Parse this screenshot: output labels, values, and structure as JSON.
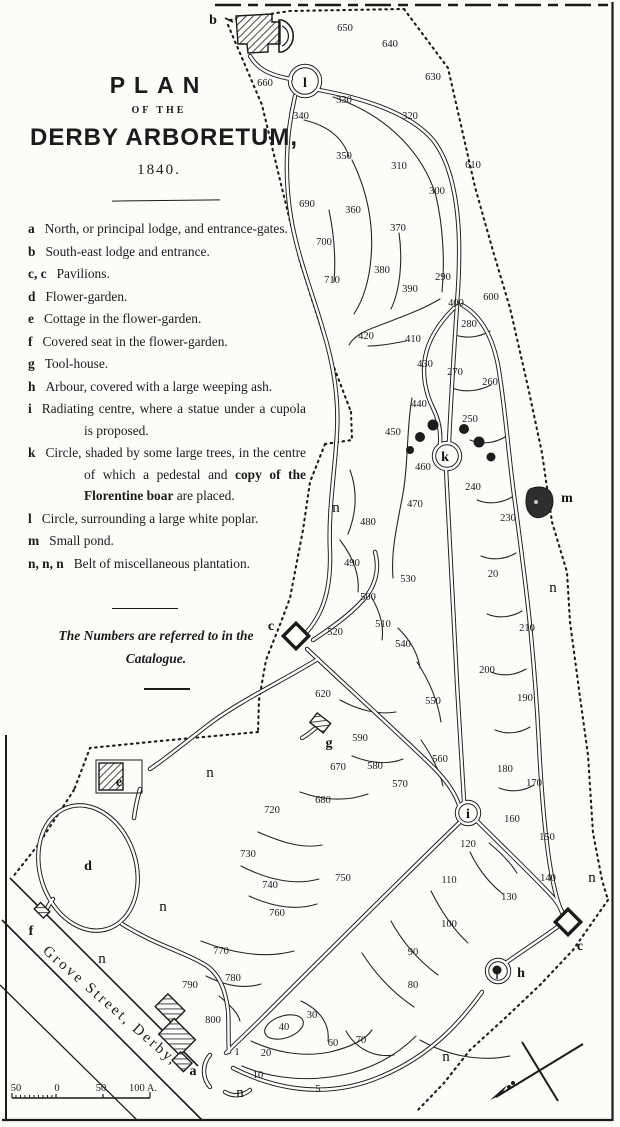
{
  "title": {
    "plan": "PLAN",
    "of_the": "OF THE",
    "name": "DERBY ARBORETUM,",
    "year": "1840."
  },
  "legend": {
    "items": [
      {
        "key": "a",
        "text": "North, or principal lodge, and entrance-gates."
      },
      {
        "key": "b",
        "text": "South-east lodge and entrance."
      },
      {
        "key": "c, c",
        "text": "Pavilions."
      },
      {
        "key": "d",
        "text": "Flower-garden."
      },
      {
        "key": "e",
        "text": "Cottage in the flower-garden."
      },
      {
        "key": "f",
        "text": "Covered seat in the flower-garden."
      },
      {
        "key": "g",
        "text": "Tool-house."
      },
      {
        "key": "h",
        "text": "Arbour, covered with a large weeping ash."
      },
      {
        "key": "i",
        "text": "Radiating centre, where a statue under a cupola is proposed."
      },
      {
        "key": "k",
        "text_before": "Circle, shaded by some large trees, in the centre of which a pedestal and ",
        "bold": "copy of the Florentine boar",
        "text_after": " are placed."
      },
      {
        "key": "l",
        "text": "Circle, surrounding a large white poplar."
      },
      {
        "key": "m",
        "text": "Small pond."
      },
      {
        "key": "n, n, n",
        "text": "Belt of miscellaneous plantation."
      }
    ]
  },
  "note": "The Numbers are referred to in the Catalogue.",
  "map": {
    "street": "Grove Street, Derby,",
    "scale_labels": [
      "50",
      "0",
      "50",
      "100 A."
    ],
    "letters": [
      {
        "t": "b",
        "x": 213,
        "y": 24
      },
      {
        "t": "l",
        "x": 305,
        "y": 87
      },
      {
        "t": "a",
        "x": 193,
        "y": 1075
      },
      {
        "t": "c",
        "x": 271,
        "y": 630
      },
      {
        "t": "c",
        "x": 580,
        "y": 950
      },
      {
        "t": "d",
        "x": 88,
        "y": 870
      },
      {
        "t": "e",
        "x": 119,
        "y": 786
      },
      {
        "t": "f",
        "x": 31,
        "y": 935
      },
      {
        "t": "g",
        "x": 329,
        "y": 747
      },
      {
        "t": "h",
        "x": 521,
        "y": 977
      },
      {
        "t": "i",
        "x": 468,
        "y": 818
      },
      {
        "t": "k",
        "x": 445,
        "y": 461
      },
      {
        "t": "m",
        "x": 567,
        "y": 502
      },
      {
        "t": "n",
        "x": 336,
        "y": 512
      },
      {
        "t": "n",
        "x": 553,
        "y": 592
      },
      {
        "t": "n",
        "x": 210,
        "y": 777
      },
      {
        "t": "n",
        "x": 163,
        "y": 911
      },
      {
        "t": "n",
        "x": 102,
        "y": 963
      },
      {
        "t": "n",
        "x": 240,
        "y": 1097
      },
      {
        "t": "n",
        "x": 592,
        "y": 882
      },
      {
        "t": "n",
        "x": 446,
        "y": 1061
      }
    ],
    "numbers": [
      {
        "t": "650",
        "x": 345,
        "y": 31
      },
      {
        "t": "640",
        "x": 390,
        "y": 47
      },
      {
        "t": "630",
        "x": 433,
        "y": 80
      },
      {
        "t": "660",
        "x": 265,
        "y": 86
      },
      {
        "t": "330",
        "x": 344,
        "y": 103
      },
      {
        "t": "340",
        "x": 301,
        "y": 119
      },
      {
        "t": "320",
        "x": 410,
        "y": 119
      },
      {
        "t": "350",
        "x": 344,
        "y": 159
      },
      {
        "t": "310",
        "x": 399,
        "y": 169
      },
      {
        "t": "610",
        "x": 473,
        "y": 168
      },
      {
        "t": "300",
        "x": 437,
        "y": 194
      },
      {
        "t": "690",
        "x": 307,
        "y": 207
      },
      {
        "t": "360",
        "x": 353,
        "y": 213
      },
      {
        "t": "370",
        "x": 398,
        "y": 231
      },
      {
        "t": "700",
        "x": 324,
        "y": 245
      },
      {
        "t": "380",
        "x": 382,
        "y": 273
      },
      {
        "t": "290",
        "x": 443,
        "y": 280
      },
      {
        "t": "710",
        "x": 332,
        "y": 283
      },
      {
        "t": "390",
        "x": 410,
        "y": 292
      },
      {
        "t": "600",
        "x": 491,
        "y": 300
      },
      {
        "t": "400",
        "x": 456,
        "y": 306
      },
      {
        "t": "280",
        "x": 469,
        "y": 327
      },
      {
        "t": "420",
        "x": 366,
        "y": 339
      },
      {
        "t": "410",
        "x": 413,
        "y": 342
      },
      {
        "t": "430",
        "x": 425,
        "y": 367
      },
      {
        "t": "270",
        "x": 455,
        "y": 375
      },
      {
        "t": "260",
        "x": 490,
        "y": 385
      },
      {
        "t": "440",
        "x": 419,
        "y": 407
      },
      {
        "t": "250",
        "x": 470,
        "y": 422
      },
      {
        "t": "450",
        "x": 393,
        "y": 435
      },
      {
        "t": "460",
        "x": 423,
        "y": 470
      },
      {
        "t": "240",
        "x": 473,
        "y": 490
      },
      {
        "t": "470",
        "x": 415,
        "y": 507
      },
      {
        "t": "230",
        "x": 508,
        "y": 521
      },
      {
        "t": "480",
        "x": 368,
        "y": 525
      },
      {
        "t": "490",
        "x": 352,
        "y": 566
      },
      {
        "t": "20",
        "x": 493,
        "y": 577
      },
      {
        "t": "530",
        "x": 408,
        "y": 582
      },
      {
        "t": "500",
        "x": 368,
        "y": 600
      },
      {
        "t": "510",
        "x": 383,
        "y": 627
      },
      {
        "t": "520",
        "x": 335,
        "y": 635
      },
      {
        "t": "210",
        "x": 527,
        "y": 631
      },
      {
        "t": "540",
        "x": 403,
        "y": 647
      },
      {
        "t": "200",
        "x": 487,
        "y": 673
      },
      {
        "t": "620",
        "x": 323,
        "y": 697
      },
      {
        "t": "190",
        "x": 525,
        "y": 701
      },
      {
        "t": "550",
        "x": 433,
        "y": 704
      },
      {
        "t": "590",
        "x": 360,
        "y": 741
      },
      {
        "t": "560",
        "x": 440,
        "y": 762
      },
      {
        "t": "670",
        "x": 338,
        "y": 770
      },
      {
        "t": "580",
        "x": 375,
        "y": 769
      },
      {
        "t": "180",
        "x": 505,
        "y": 772
      },
      {
        "t": "570",
        "x": 400,
        "y": 787
      },
      {
        "t": "170",
        "x": 534,
        "y": 786
      },
      {
        "t": "680",
        "x": 323,
        "y": 803
      },
      {
        "t": "720",
        "x": 272,
        "y": 813
      },
      {
        "t": "160",
        "x": 512,
        "y": 822
      },
      {
        "t": "150",
        "x": 547,
        "y": 840
      },
      {
        "t": "120",
        "x": 468,
        "y": 847
      },
      {
        "t": "730",
        "x": 248,
        "y": 857
      },
      {
        "t": "750",
        "x": 343,
        "y": 881
      },
      {
        "t": "110",
        "x": 449,
        "y": 883
      },
      {
        "t": "140",
        "x": 548,
        "y": 881
      },
      {
        "t": "740",
        "x": 270,
        "y": 888
      },
      {
        "t": "130",
        "x": 509,
        "y": 900
      },
      {
        "t": "760",
        "x": 277,
        "y": 916
      },
      {
        "t": "100",
        "x": 449,
        "y": 927
      },
      {
        "t": "90",
        "x": 413,
        "y": 955
      },
      {
        "t": "770",
        "x": 221,
        "y": 954
      },
      {
        "t": "80",
        "x": 413,
        "y": 988
      },
      {
        "t": "780",
        "x": 233,
        "y": 981
      },
      {
        "t": "790",
        "x": 190,
        "y": 988
      },
      {
        "t": "30",
        "x": 312,
        "y": 1018
      },
      {
        "t": "800",
        "x": 213,
        "y": 1023
      },
      {
        "t": "40",
        "x": 284,
        "y": 1030
      },
      {
        "t": "20",
        "x": 266,
        "y": 1056
      },
      {
        "t": "1",
        "x": 237,
        "y": 1055
      },
      {
        "t": "60",
        "x": 333,
        "y": 1046
      },
      {
        "t": "70",
        "x": 361,
        "y": 1043
      },
      {
        "t": "10",
        "x": 258,
        "y": 1078
      },
      {
        "t": "5",
        "x": 318,
        "y": 1092
      }
    ]
  },
  "colors": {
    "paper": "#fcfcf9",
    "ink": "#1b1b1b",
    "pond": "#2e2e2e"
  }
}
